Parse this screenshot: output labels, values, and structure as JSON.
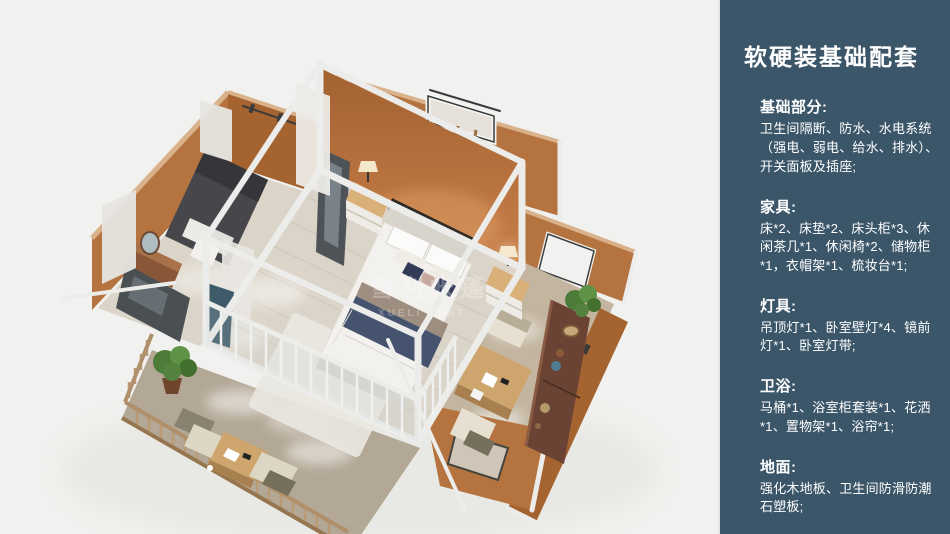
{
  "panel": {
    "title": "软硬装基础配套",
    "sections": [
      {
        "heading": "基础部分:",
        "body": "卫生间隔断、防水、水电系统（强电、弱电、给水、排水）、开关面板及插座;"
      },
      {
        "heading": "家具:",
        "body": "床*2、床垫*2、床头柜*3、休闲茶几*1、休闲椅*2、储物柜*1，衣帽架*1、梳妆台*1;"
      },
      {
        "heading": "灯具:",
        "body": "吊顶灯*1、卧室壁灯*4、镜前灯*1、卧室灯带;"
      },
      {
        "heading": "卫浴:",
        "body": "马桶*1、浴室柜套装*1、花洒*1、置物架*1、浴帘*1;"
      },
      {
        "heading": "地面:",
        "body": "强化木地板、卫生间防滑防潮石塑板;"
      }
    ]
  },
  "illustration": {
    "watermark_cn": "雪利帐篷",
    "watermark_en": "XUELI TENT"
  },
  "theme": {
    "panel_bg": "#3b5669",
    "panel_text": "#ffffff",
    "canvas_bg": "#f1f1ef",
    "wall": "#b5743f",
    "wall_dark": "#a5632f",
    "wall_light": "#c98f5e",
    "wall_edge": "#d9b28c",
    "floor_wood": "#dbd4c8",
    "deck_wood": "#b3a795",
    "deck_rail": "#b0906a",
    "frame_white": "#ececea",
    "bedding_white": "#f2f1ee",
    "accent_navy": "#46536e",
    "curtain_navy": "#3f5a68",
    "furniture_wood": "#cda56d",
    "dark_wood": "#6b4334",
    "plant_green": "#55823f",
    "sofa_dark": "#47474b"
  }
}
